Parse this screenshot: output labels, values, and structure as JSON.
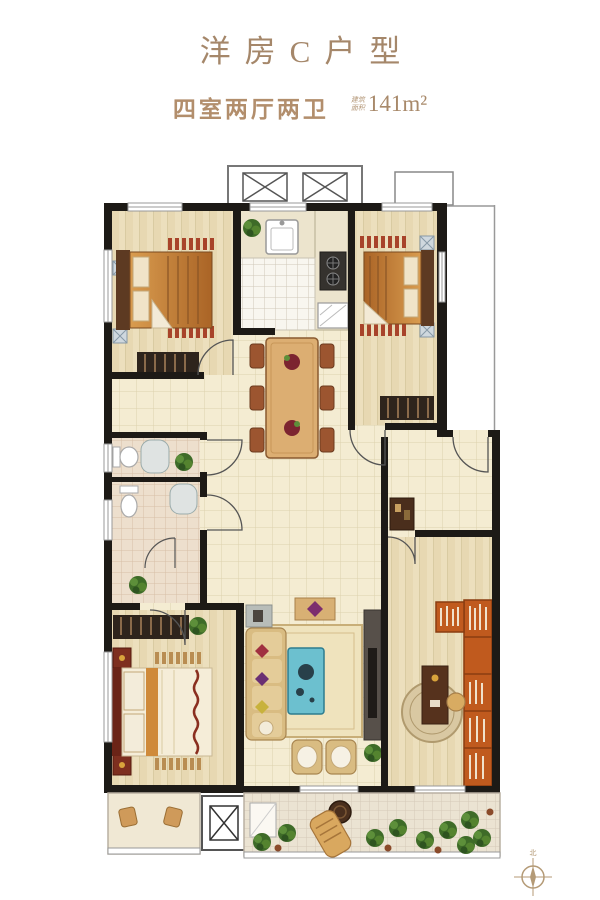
{
  "header": {
    "title": "洋房C户型",
    "subtitle": "四室两厅两卫",
    "area_label_top": "建筑",
    "area_label_bottom": "面积",
    "area_value": "141m²"
  },
  "compass": {
    "north_label": "北"
  },
  "palette": {
    "title_text": "#a5876a",
    "subtitle_text": "#b28e6c",
    "wall_black": "#1d1a16",
    "floor_cream": "#f4ecd2",
    "floor_wood": "#ecdfbd",
    "bath_tile": "#eddfcd",
    "kitchen_tile": "#f8f6ef",
    "bed_orange": "#c98436",
    "nightstand_red": "#a8432a",
    "bookshelf_orange": "#c05a1e",
    "coffee_table_teal": "#6cc0cf",
    "sofa_tan": "#d9bc82",
    "plant_green": "#3e6b28",
    "rug_beige": "#efe3bd",
    "window_line": "#999999"
  },
  "plan": {
    "rooms": [
      "elevator-hall",
      "bedroom-top-left",
      "kitchen",
      "bedroom-top-right",
      "dining-area",
      "hallway",
      "entry-foyer",
      "bathroom-1",
      "bathroom-2",
      "master-bedroom",
      "living-room",
      "study",
      "main-balcony",
      "small-balcony",
      "duct-shaft"
    ],
    "fixtures": [
      "elevator-x-boxes",
      "sink",
      "stove",
      "fridge",
      "toilets",
      "showers",
      "beds",
      "wardrobes",
      "dining-table",
      "sofa-set",
      "coffee-table",
      "tv-cabinet",
      "desk",
      "bookshelf",
      "balcony-plants",
      "lounge-chair"
    ]
  }
}
